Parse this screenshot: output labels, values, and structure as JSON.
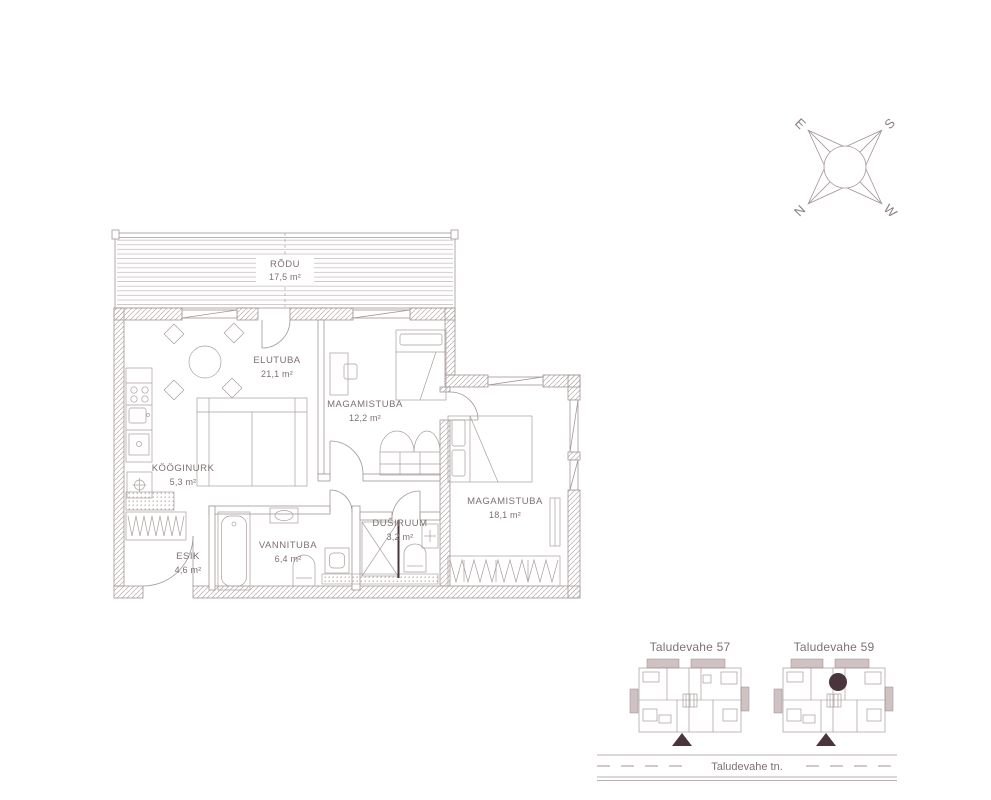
{
  "colors": {
    "line": "#a39696",
    "text": "#7e7070",
    "accent_dark": "#4b353c",
    "balcony_shade": "#cfc2c2"
  },
  "compass": {
    "north": "N",
    "east": "E",
    "south": "S",
    "west": "W"
  },
  "floor_plan": {
    "rooms": [
      {
        "name": "RÕDU",
        "area": "17,5 m²"
      },
      {
        "name": "ELUTUBA",
        "area": "21,1 m²"
      },
      {
        "name": "MAGAMISTUBA",
        "area": "12,2 m²"
      },
      {
        "name": "MAGAMISTUBA",
        "area": "18,1 m²"
      },
      {
        "name": "KÖÖGINURK",
        "area": "5,3 m²"
      },
      {
        "name": "ESIK",
        "area": "4,6 m²"
      },
      {
        "name": "VANNITUBA",
        "area": "6,4 m²"
      },
      {
        "name": "DUŠIRUUM",
        "area": "3,2 m²"
      }
    ]
  },
  "site_plan": {
    "buildings": [
      {
        "label": "Taludevahe 57",
        "highlighted": false
      },
      {
        "label": "Taludevahe 59",
        "highlighted": true
      }
    ],
    "street_label": "Taludevahe tn."
  }
}
